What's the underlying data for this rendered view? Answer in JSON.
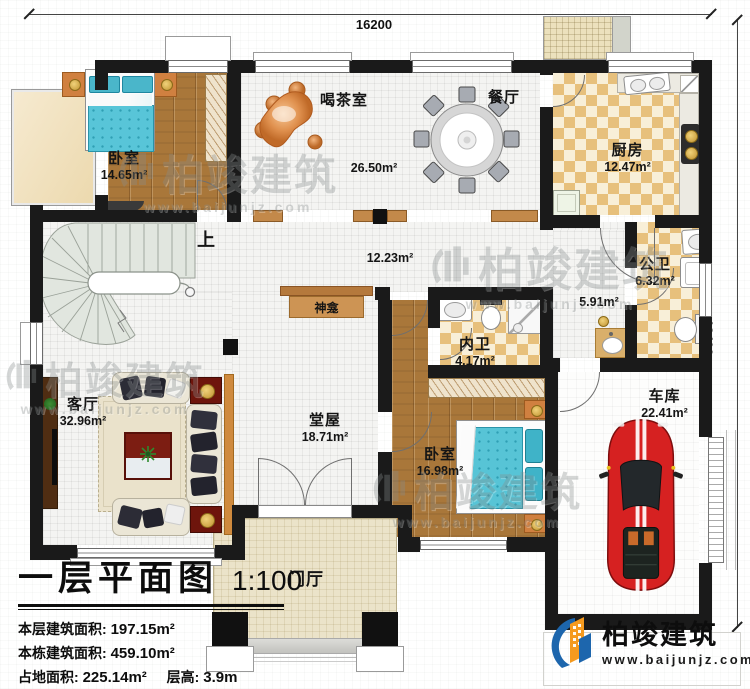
{
  "dimensions": {
    "top": "16200",
    "right": "13400"
  },
  "rooms": {
    "bedroom1": {
      "name": "卧室",
      "area": "14.65m²"
    },
    "tea_room": {
      "name": "喝茶室",
      "area": "26.50m²"
    },
    "dining": {
      "name": "餐厅"
    },
    "kitchen": {
      "name": "厨房",
      "area": "12.47m²"
    },
    "hallway": {
      "area": "12.23m²"
    },
    "corridor": {
      "area": "5.91m²"
    },
    "public_bath": {
      "name": "公卫",
      "area": "6.32m²"
    },
    "inner_bath": {
      "name": "内卫",
      "area": "4.17m²"
    },
    "bedroom2": {
      "name": "卧室",
      "area": "16.98m²"
    },
    "garage": {
      "name": "车库",
      "area": "22.41m²"
    },
    "living": {
      "name": "客厅",
      "area": "32.96m²"
    },
    "main_hall": {
      "name": "堂屋",
      "area": "18.71m²"
    },
    "porch": {
      "name": "门厅"
    },
    "shrine": {
      "name": "神龛"
    },
    "stair": {
      "up": "上"
    }
  },
  "title_block": {
    "title": "一层平面图",
    "scale": "1:100",
    "stats": [
      {
        "label": "本层建筑面积:",
        "value": "197.15m²"
      },
      {
        "label": "本栋建筑面积:",
        "value": "459.10m²"
      },
      {
        "label": "占地面积:",
        "value": "225.14m²",
        "label2": "层高:",
        "value2": "3.9m"
      }
    ]
  },
  "branding": {
    "name": "柏竣建筑",
    "website": "www.baijunjz.com"
  },
  "watermark": {
    "name": "柏竣建筑",
    "website": "www.baijunjz.com"
  },
  "colors": {
    "wall": "#1a1a1a",
    "wood": "#a9773a",
    "checker": "#e7c07c",
    "tile": "#f4f4f2",
    "water_blue": "#57c4d6",
    "car_red": "#d62121",
    "porch": "#ebe3c9",
    "logo_blue": "#1d66ad",
    "logo_orange": "#f59a1f"
  }
}
